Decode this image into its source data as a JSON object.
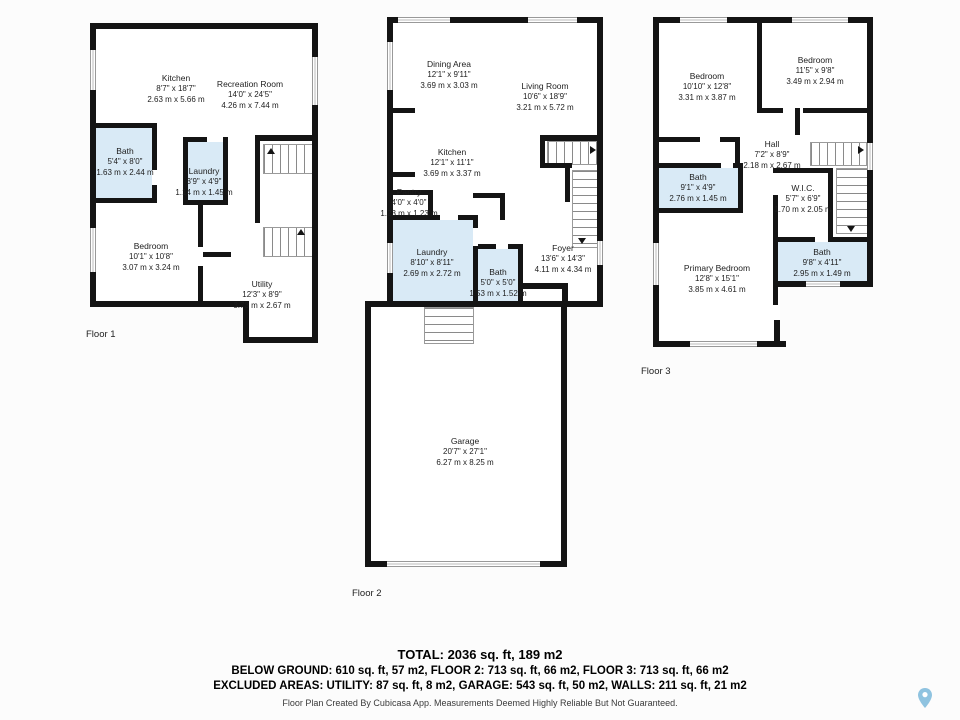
{
  "colors": {
    "wall": "#141414",
    "wet_room": "#d9eaf6",
    "pin": "#8fc3e0"
  },
  "floors": [
    {
      "label": "Floor 1",
      "rooms": [
        {
          "name": "Kitchen",
          "imperial": "8'7\" x 18'7\"",
          "metric": "2.63 m x 5.66 m"
        },
        {
          "name": "Recreation Room",
          "imperial": "14'0\" x 24'5\"",
          "metric": "4.26 m x 7.44 m"
        },
        {
          "name": "Bath",
          "imperial": "5'4\" x 8'0\"",
          "metric": "1.63 m x 2.44 m"
        },
        {
          "name": "Laundry",
          "imperial": "3'9\" x 4'9\"",
          "metric": "1.14 m x 1.45 m"
        },
        {
          "name": "Bedroom",
          "imperial": "10'1\" x 10'8\"",
          "metric": "3.07 m x 3.24 m"
        },
        {
          "name": "Utility",
          "imperial": "12'3\" x 8'9\"",
          "metric": "3.73 m x 2.67 m"
        }
      ]
    },
    {
      "label": "Floor 2",
      "rooms": [
        {
          "name": "Dining Area",
          "imperial": "12'1\" x 9'11\"",
          "metric": "3.69 m x 3.03 m"
        },
        {
          "name": "Living Room",
          "imperial": "10'6\" x 18'9\"",
          "metric": "3.21 m x 5.72 m"
        },
        {
          "name": "Kitchen",
          "imperial": "12'1\" x 11'1\"",
          "metric": "3.69 m x 3.37 m"
        },
        {
          "name": "Pantry",
          "imperial": "4'0\" x 4'0\"",
          "metric": "1.23 m x 1.23 m"
        },
        {
          "name": "Laundry",
          "imperial": "8'10\" x 8'11\"",
          "metric": "2.69 m x 2.72 m"
        },
        {
          "name": "Bath",
          "imperial": "5'0\" x 5'0\"",
          "metric": "1.53 m x 1.52 m"
        },
        {
          "name": "Foyer",
          "imperial": "13'6\" x 14'3\"",
          "metric": "4.11 m x 4.34 m"
        },
        {
          "name": "Garage",
          "imperial": "20'7\" x 27'1\"",
          "metric": "6.27 m x 8.25 m"
        }
      ]
    },
    {
      "label": "Floor 3",
      "rooms": [
        {
          "name": "Bedroom",
          "imperial": "10'10\" x 12'8\"",
          "metric": "3.31 m x 3.87 m"
        },
        {
          "name": "Bedroom",
          "imperial": "11'5\" x 9'8\"",
          "metric": "3.49 m x 2.94 m"
        },
        {
          "name": "Hall",
          "imperial": "7'2\" x 8'9\"",
          "metric": "2.18 m x 2.67 m"
        },
        {
          "name": "Bath",
          "imperial": "9'1\" x 4'9\"",
          "metric": "2.76 m x 1.45 m"
        },
        {
          "name": "W.I.C.",
          "imperial": "5'7\" x 6'9\"",
          "metric": "1.70 m x 2.05 m"
        },
        {
          "name": "Bath",
          "imperial": "9'8\" x 4'11\"",
          "metric": "2.95 m x 1.49 m"
        },
        {
          "name": "Primary Bedroom",
          "imperial": "12'8\" x 15'1\"",
          "metric": "3.85 m x 4.61 m"
        }
      ]
    }
  ],
  "summary": {
    "total": "TOTAL: 2036 sq. ft, 189 m2",
    "floor_areas": "BELOW GROUND: 610 sq. ft, 57 m2, FLOOR 2: 713 sq. ft, 66 m2, FLOOR 3: 713 sq. ft, 66 m2",
    "excluded_areas": "EXCLUDED AREAS: UTILITY: 87 sq. ft, 8 m2, GARAGE: 543 sq. ft, 50 m2, WALLS: 211 sq. ft, 21 m2",
    "credit": "Floor Plan Created By Cubicasa App. Measurements Deemed Highly Reliable But Not Guaranteed."
  }
}
